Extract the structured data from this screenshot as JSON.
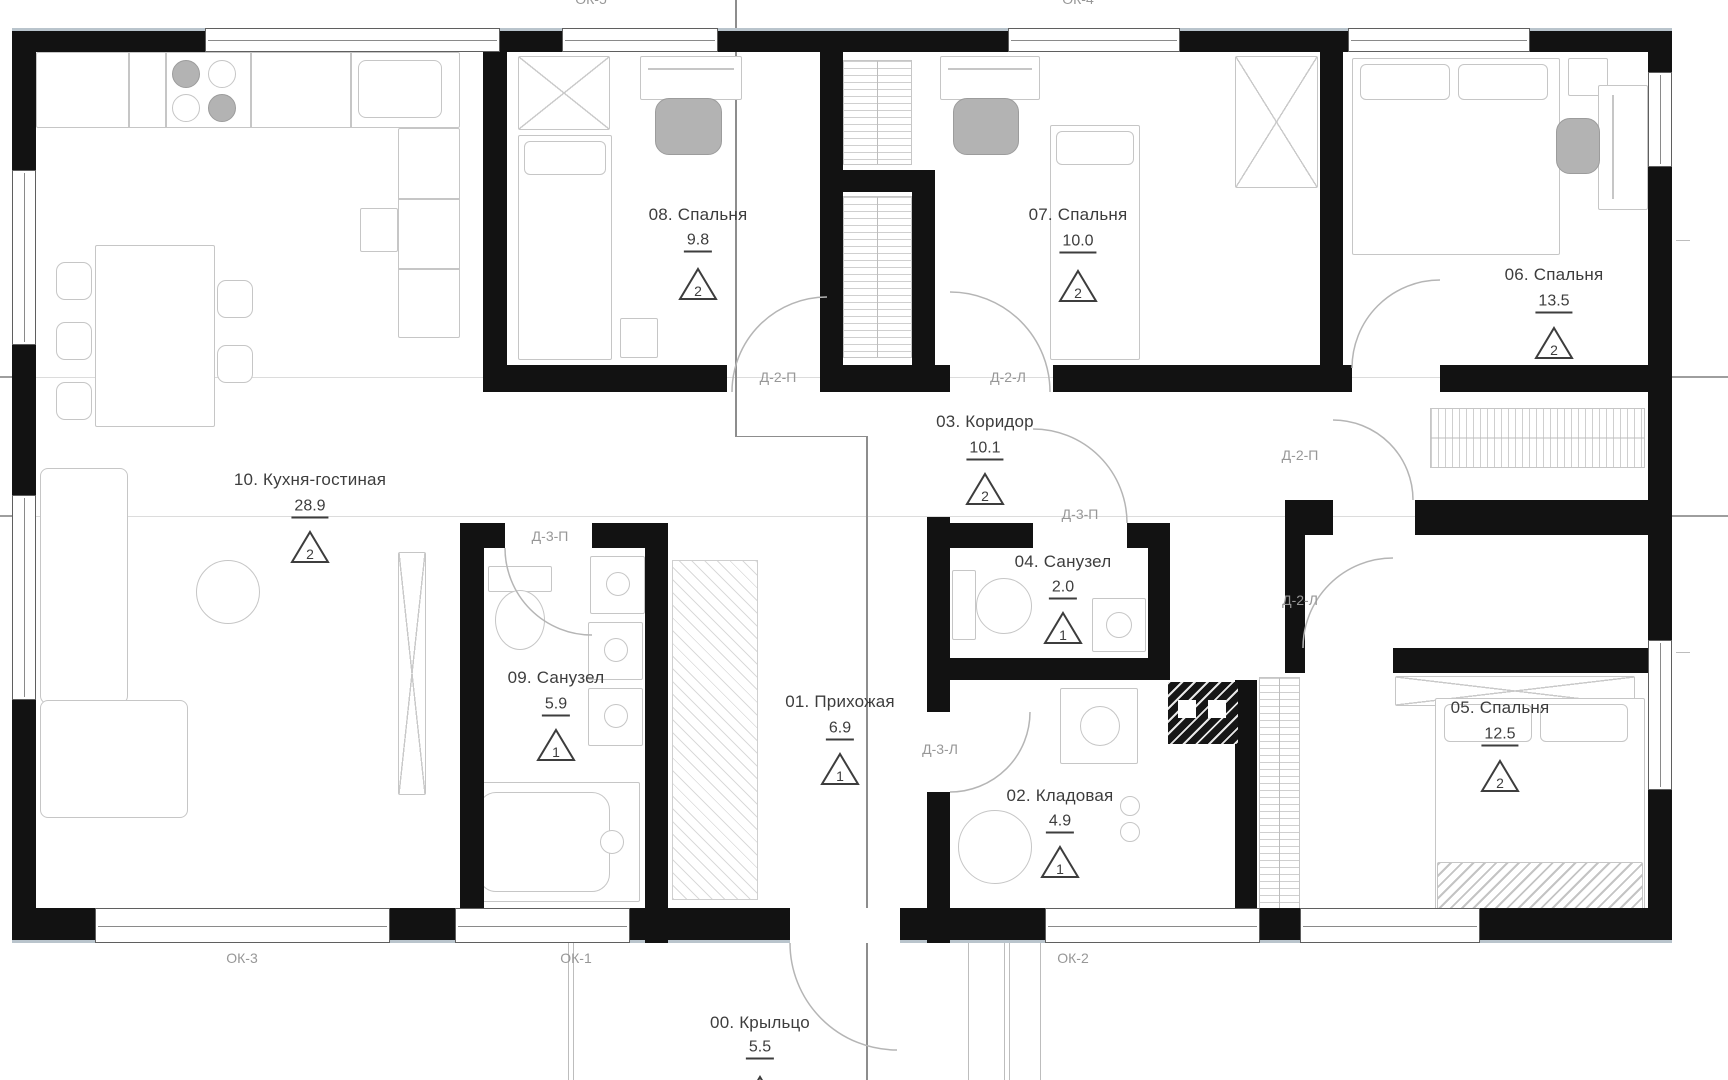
{
  "rooms": [
    {
      "number": "10",
      "label": "10. Кухня-гостиная",
      "area": "28.9",
      "occupancy": "2"
    },
    {
      "number": "08",
      "label": "08. Спальня",
      "area": "9.8",
      "occupancy": "2"
    },
    {
      "number": "07",
      "label": "07. Спальня",
      "area": "10.0",
      "occupancy": "2"
    },
    {
      "number": "06",
      "label": "06. Спальня",
      "area": "13.5",
      "occupancy": "2"
    },
    {
      "number": "03",
      "label": "03. Коридор",
      "area": "10.1",
      "occupancy": "2"
    },
    {
      "number": "04",
      "label": "04. Санузел",
      "area": "2.0",
      "occupancy": "1"
    },
    {
      "number": "09",
      "label": "09. Санузел",
      "area": "5.9",
      "occupancy": "1"
    },
    {
      "number": "01",
      "label": "01. Прихожая",
      "area": "6.9",
      "occupancy": "1"
    },
    {
      "number": "02",
      "label": "02. Кладовая",
      "area": "4.9",
      "occupancy": "1"
    },
    {
      "number": "05",
      "label": "05. Спальня",
      "area": "12.5",
      "occupancy": "2"
    },
    {
      "number": "00",
      "label": "00. Крыльцо",
      "area": "5.5",
      "occupancy": "1"
    }
  ],
  "door_labels": [
    {
      "text": "Д-2-П"
    },
    {
      "text": "Д-2-Л"
    },
    {
      "text": "Д-2-П"
    },
    {
      "text": "Д-2-Л"
    },
    {
      "text": "Д-3-П"
    },
    {
      "text": "Д-3-П"
    },
    {
      "text": "Д-3-Л"
    }
  ],
  "window_labels": [
    {
      "text": "ОК-5"
    },
    {
      "text": "ОК-4"
    },
    {
      "text": "ОК-3"
    },
    {
      "text": "ОК-1"
    },
    {
      "text": "ОК-2"
    }
  ],
  "colors": {
    "wall": "#121212",
    "furniture_stroke": "#c6c6c6",
    "label_text": "#3d3d3d",
    "annotation_text": "#979797",
    "top_wall_face": "#b9c4cc"
  }
}
